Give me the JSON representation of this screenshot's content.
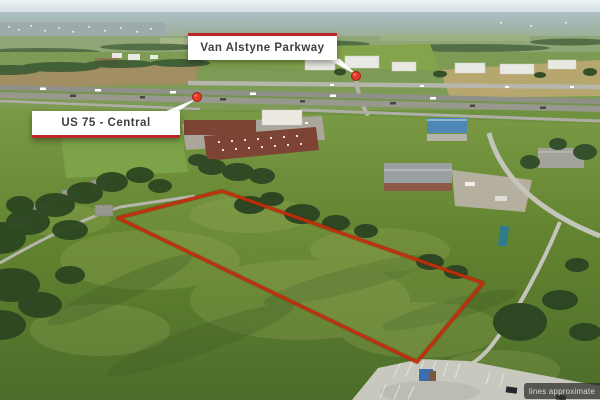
{
  "callouts": {
    "parkway": {
      "label": "Van Alstyne Parkway"
    },
    "highway": {
      "label": "US 75 - Central"
    }
  },
  "disclaimer": {
    "text": "lines approximate"
  },
  "icons": {
    "parkway_pin": "map-pin-icon",
    "highway_pin": "map-pin-icon"
  },
  "colors": {
    "callout_accent": "#bc2727",
    "callout_bg": "#ffffff",
    "callout_text": "#3f3f3f",
    "boundary_red": "#c52c0b",
    "pin_red": "#e23b28",
    "disclaimer_bg": "rgba(40,40,40,0.72)",
    "disclaimer_text": "#d9d9d9"
  }
}
